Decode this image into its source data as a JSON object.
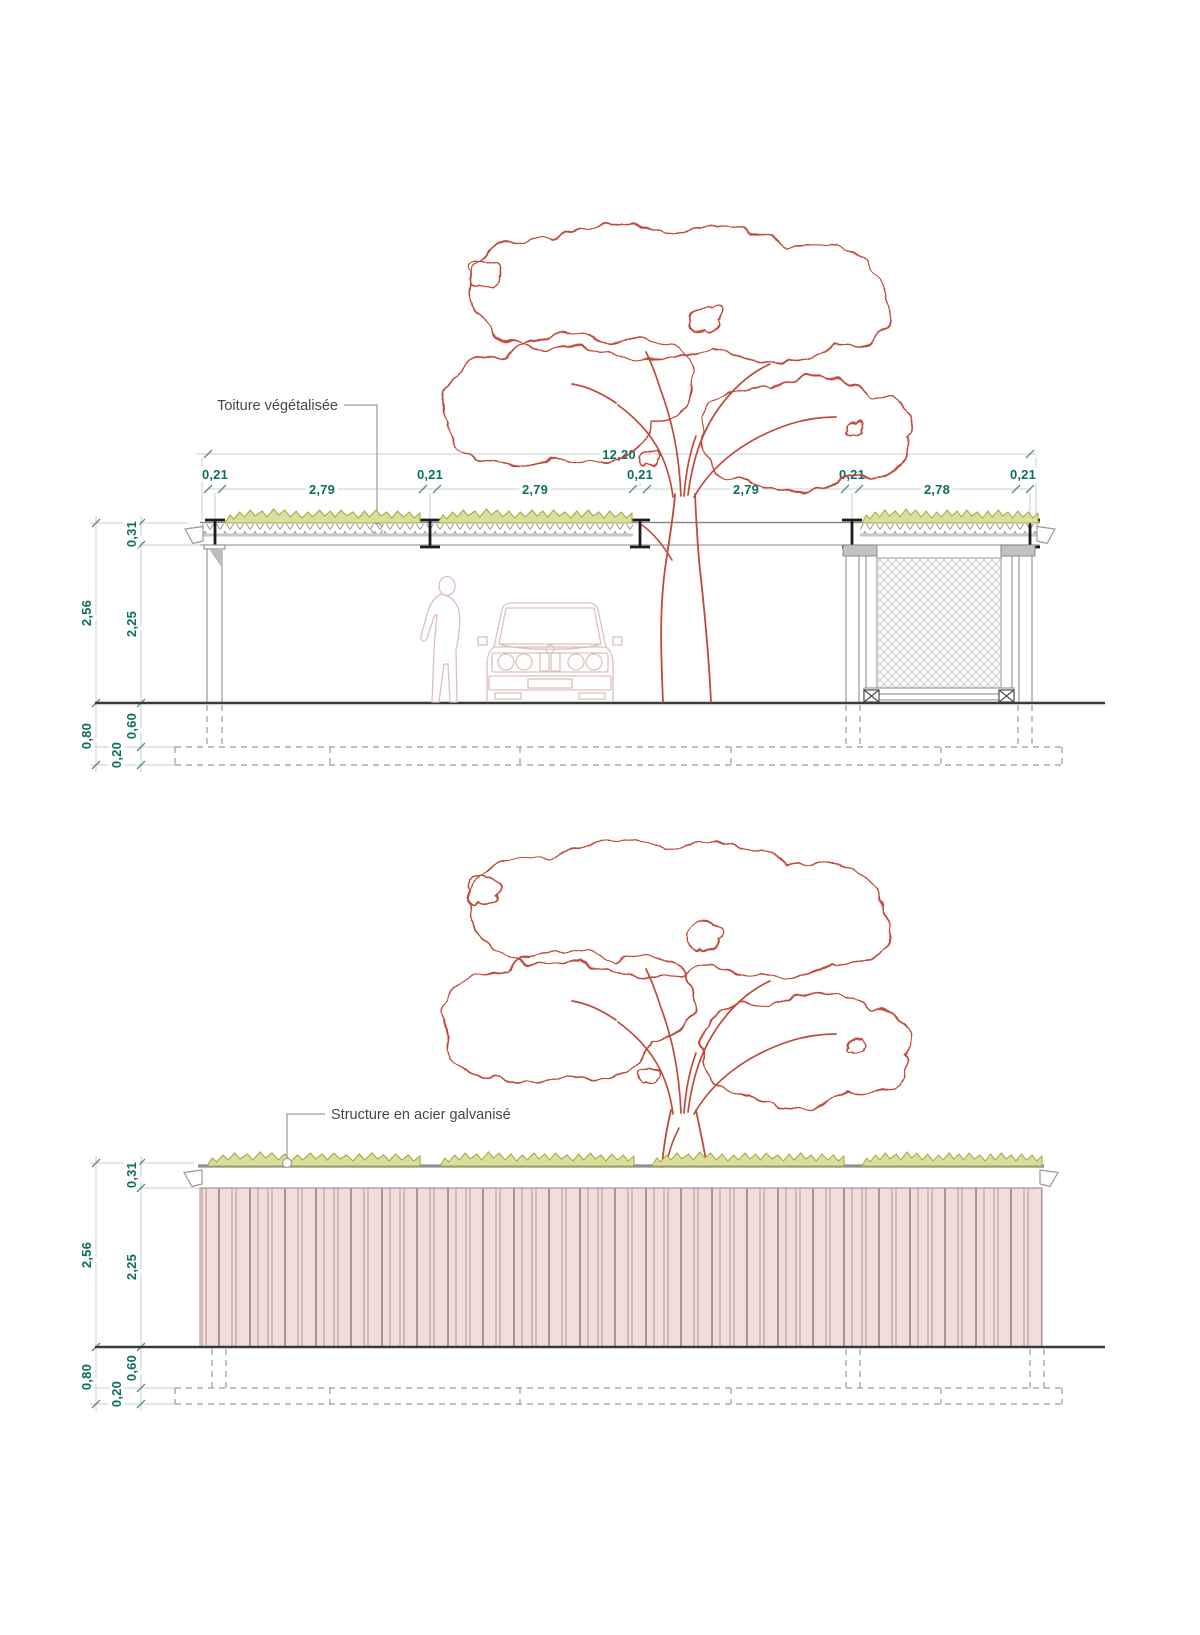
{
  "colors": {
    "dimension_text": "#0e6e5f",
    "dimension_line": "#c3d2cf",
    "tree_outline": "#bf4a3a",
    "vegetation_stroke": "#a6ab3c",
    "vegetation_fill": "#dbde9e",
    "structure_gray": "#9a9a9a",
    "steel_beam_dark": "#1d1d1d",
    "ground_line": "#3a3a3a",
    "facade_fill": "#f0dddc",
    "facade_line": "#ab8786",
    "silhouette": "#dcc0bc",
    "annotation_text": "#474747"
  },
  "section": {
    "annotation": "Toiture végétalisée",
    "dims": {
      "total_width": "12,20",
      "chain": [
        "0,21",
        "2,79",
        "0,21",
        "2,79",
        "0,21",
        "2,79",
        "0,21",
        "2,78",
        "0,21"
      ],
      "height_total": "2,56",
      "roof_thickness": "0,31",
      "clear_height": "2,25",
      "foundation_total": "0,80",
      "foundation_upper": "0,60",
      "footing_thickness": "0,20"
    }
  },
  "elevation": {
    "annotation": "Structure en acier galvanisé",
    "dims": {
      "height_total": "2,56",
      "roof_thickness": "0,31",
      "clear_height": "2,25",
      "foundation_total": "0,80",
      "foundation_upper": "0,60",
      "footing_thickness": "0,20"
    }
  }
}
